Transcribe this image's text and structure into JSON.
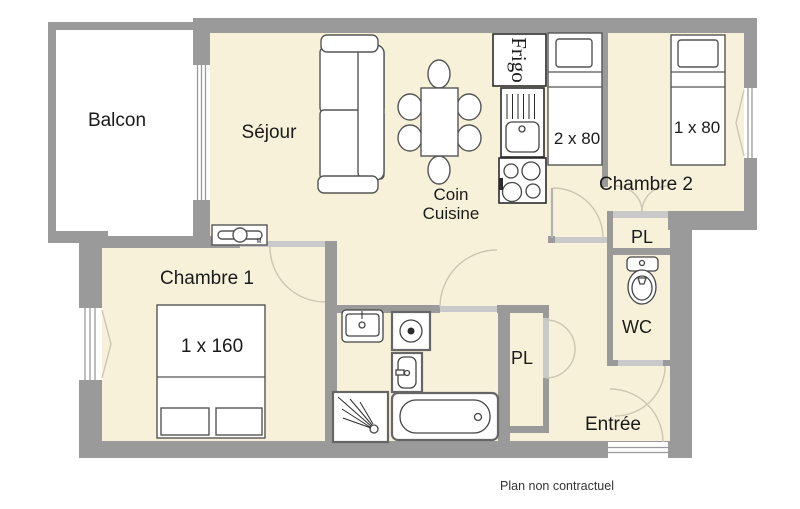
{
  "footer": {
    "disclaimer": "Plan non contractuel"
  },
  "colors": {
    "wall": "#9a9a9a",
    "floor": "#f8f1da",
    "door_opening": "#c9c9c9",
    "fixture_outline": "#555555",
    "text": "#1a1a1a",
    "background": "#ffffff"
  },
  "rooms": {
    "balcon": {
      "label": "Balcon"
    },
    "sejour": {
      "label": "Séjour"
    },
    "coin_cuisine": {
      "label_line1": "Coin",
      "label_line2": "Cuisine"
    },
    "chambre1": {
      "label": "Chambre 1",
      "bed_size": "1 x 160"
    },
    "chambre2": {
      "label": "Chambre 2",
      "bed_size": "1 x 80"
    },
    "coin_nuit": {
      "bed_size": "2 x 80"
    },
    "pl_upper": {
      "label": "PL"
    },
    "pl_lower": {
      "label": "PL"
    },
    "wc": {
      "label": "WC"
    },
    "entree": {
      "label": "Entrée"
    }
  },
  "appliances": {
    "frigo_label": "Frigo",
    "radiator_tag": "M"
  }
}
